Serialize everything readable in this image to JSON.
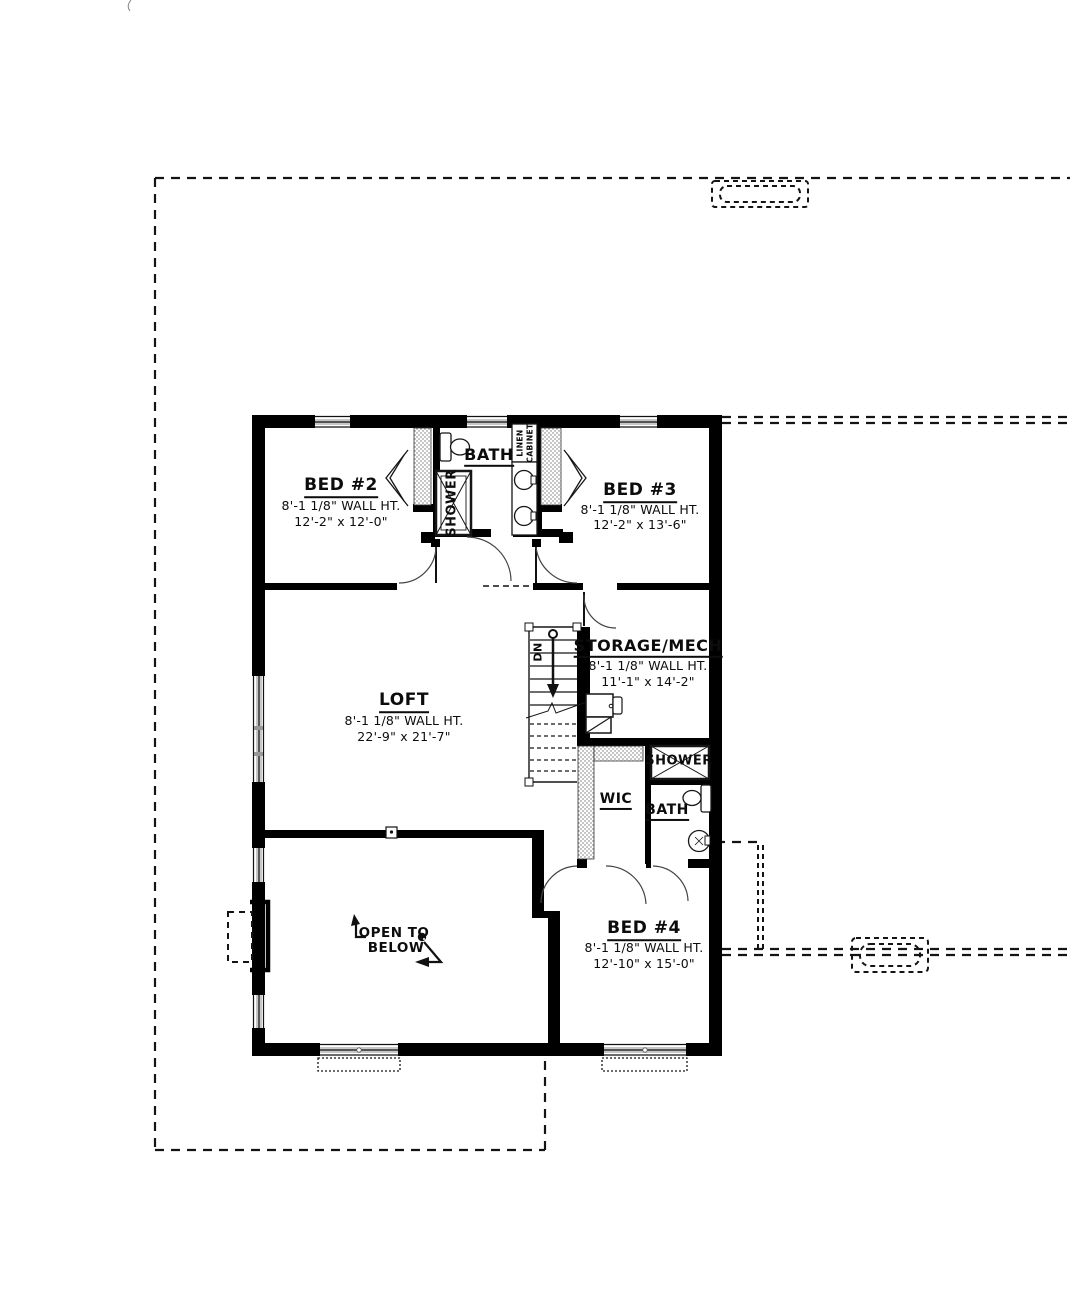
{
  "colors": {
    "wall": "#000000",
    "line": "#161616",
    "window_fill": "#c7c7c7",
    "background": "#ffffff"
  },
  "rooms": {
    "bed2": {
      "name": "BED #2",
      "wall_ht": "8'-1 1/8\" WALL HT.",
      "dims": "12'-2\" x 12'-0\""
    },
    "bed3": {
      "name": "BED #3",
      "wall_ht": "8'-1 1/8\" WALL HT.",
      "dims": "12'-2\" x 13'-6\""
    },
    "bed4": {
      "name": "BED #4",
      "wall_ht": "8'-1 1/8\" WALL HT.",
      "dims": "12'-10\" x 15'-0\""
    },
    "loft": {
      "name": "LOFT",
      "wall_ht": "8'-1 1/8\" WALL HT.",
      "dims": "22'-9\" x 21'-7\""
    },
    "storage": {
      "name": "STORAGE/MECH",
      "wall_ht": "8'-1 1/8\" WALL HT.",
      "dims": "11'-1\" x 14'-2\""
    },
    "bath_upper": {
      "name": "BATH"
    },
    "bath_lower": {
      "name": "BATH"
    },
    "shower_upper": {
      "name": "SHOWER"
    },
    "shower_lower": {
      "name": "SHOWER"
    },
    "wic": {
      "name": "WIC"
    }
  },
  "annotations": {
    "stairs_down": "DN",
    "linen_line1": "LINEN",
    "linen_line2": "CABINET",
    "open_below_line1": "OPEN TO",
    "open_below_line2": "BELOW"
  }
}
